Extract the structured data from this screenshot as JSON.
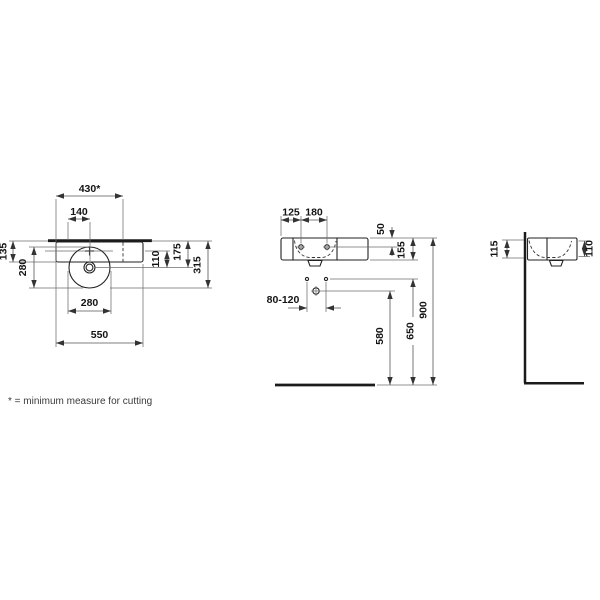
{
  "footnote": "* = minimum measure for cutting",
  "views": {
    "plan": {
      "dims": {
        "cutout_width": "430*",
        "bowl_radius": "140",
        "back_ledge": "135",
        "bowl_depth": "280",
        "bowl_back_offset": "110",
        "center_depth": "175",
        "total_depth": "315",
        "bowl_width": "280",
        "total_width": "550"
      }
    },
    "front": {
      "dims": {
        "left_to_tap": "125",
        "tap_spacing": "180",
        "top_to_tap": "50",
        "body_height": "155",
        "drain_height": "580",
        "fixing_height": "650",
        "rim_height": "900",
        "drain_offset": "80-120"
      }
    },
    "side": {
      "dims": {
        "back_height": "115",
        "front_height": "110"
      }
    }
  }
}
